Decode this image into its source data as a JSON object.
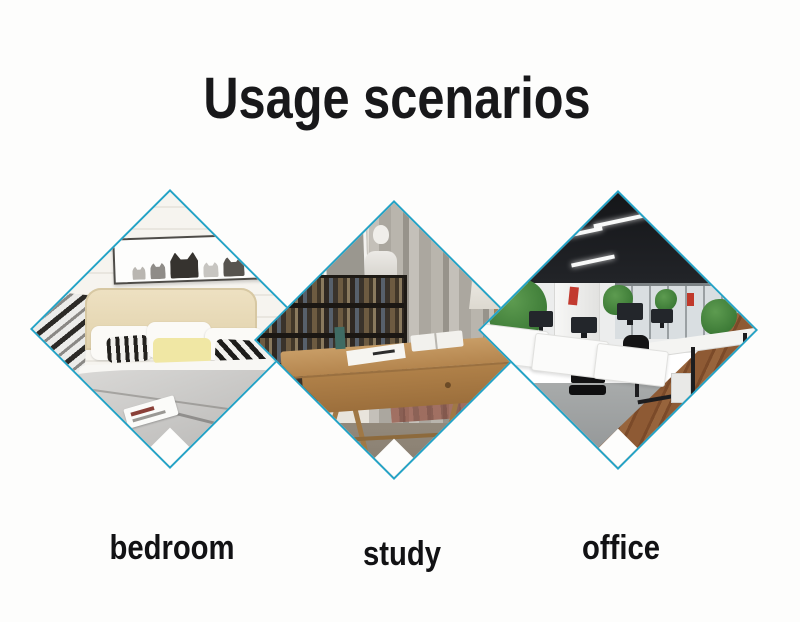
{
  "page": {
    "background": "#fdfdfc"
  },
  "header": {
    "title": "Usage scenarios"
  },
  "theme": {
    "accent": "#24a3c6",
    "title_color": "#18181a",
    "label_color": "#121214",
    "page_bg": "#fdfdfc"
  },
  "scenarios": [
    {
      "id": "bedroom",
      "label": "bedroom",
      "photo": "bedroom-photo"
    },
    {
      "id": "study",
      "label": "study",
      "photo": "study-photo"
    },
    {
      "id": "office",
      "label": "office",
      "photo": "office-photo"
    }
  ]
}
